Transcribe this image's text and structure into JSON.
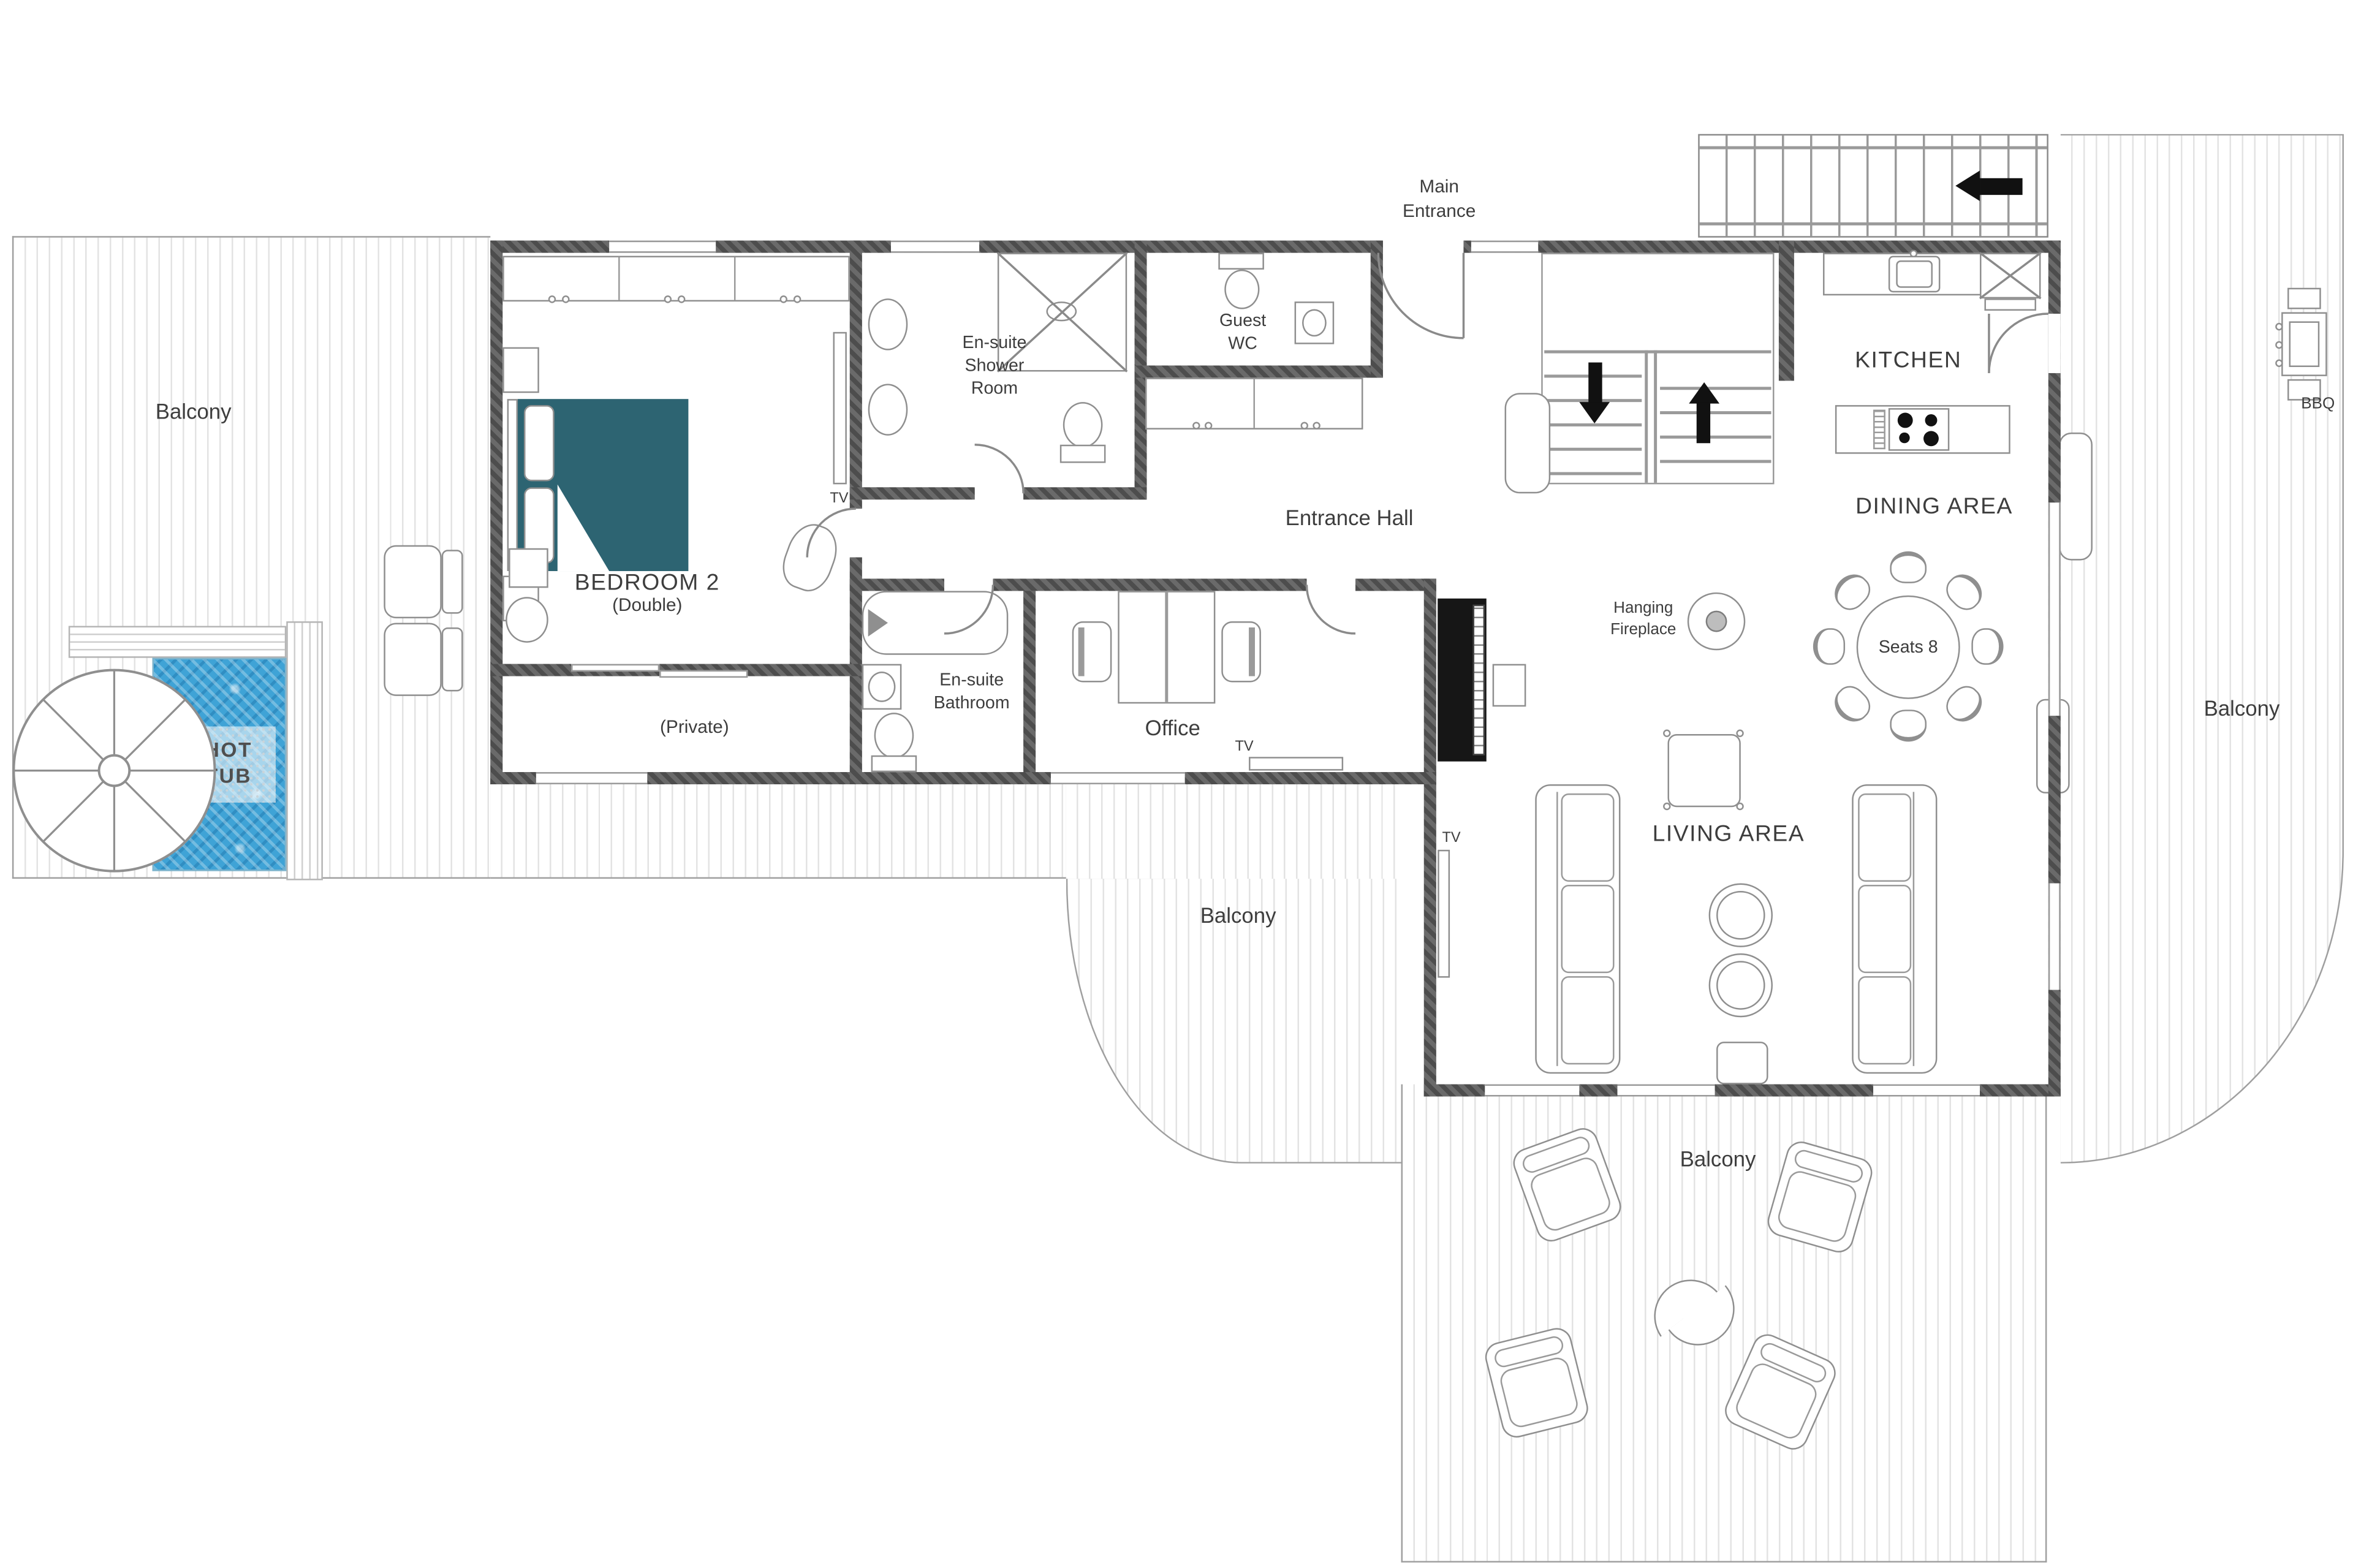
{
  "plan": {
    "type": "floor-plan",
    "colors": {
      "wall": "#575757",
      "bed_accent": "#2d6472",
      "hot_tub_water": "#3fa3d6",
      "text": "#3d3d3d",
      "deck_line": "#e3e3e3"
    },
    "labels": {
      "main_entrance": "Main\nEntrance",
      "entrance_hall": "Entrance Hall",
      "kitchen": "KITCHEN",
      "dining_area": "DINING AREA",
      "dining_seats": "Seats 8",
      "living_area": "LIVING AREA",
      "office": "Office",
      "bedroom2_title": "BEDROOM 2",
      "bedroom2_sub": "(Double)",
      "bedroom2_private": "(Private)",
      "ensuite_shower": "En-suite\nShower\nRoom",
      "guest_wc": "Guest\nWC",
      "ensuite_bathroom": "En-suite\nBathroom",
      "hanging_fireplace": "Hanging\nFireplace",
      "hot_tub": "HOT\nTUB",
      "bbq": "BBQ",
      "balcony_left": "Balcony",
      "balcony_right": "Balcony",
      "balcony_bottom": "Balcony",
      "balcony_mid": "Balcony",
      "tv_bedroom": "TV",
      "tv_office": "TV",
      "tv_living": "TV"
    }
  }
}
